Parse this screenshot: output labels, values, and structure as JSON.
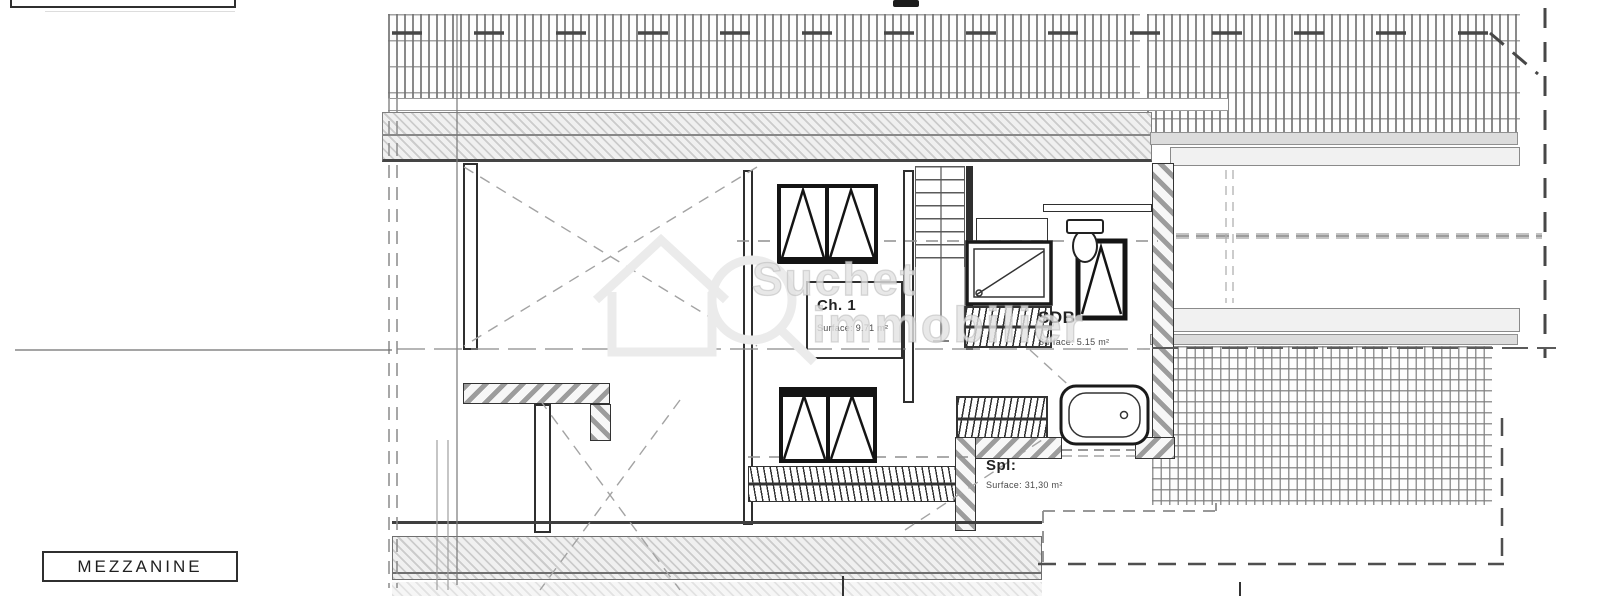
{
  "drawing": {
    "floor_label": "MEZZANINE",
    "watermark": {
      "line1": "Suchet",
      "line2": "immobilier"
    },
    "rooms": {
      "ch1": {
        "name": "Ch. 1",
        "surface": "Surface: 9.71 m²"
      },
      "sdb": {
        "name": "SDB",
        "surface": "Surface: 5.15 m²"
      },
      "spl": {
        "name": "Spl:",
        "surface": "Surface: 31,30 m²"
      }
    },
    "colors": {
      "ink": "#2f2f2f",
      "wall_hatch": "#9c9c9c",
      "band_light": "#f1f1f1",
      "band_dark": "#dcdcdc",
      "tile_line": "#8a8a8a",
      "watermark": "#e2e2e2"
    }
  }
}
